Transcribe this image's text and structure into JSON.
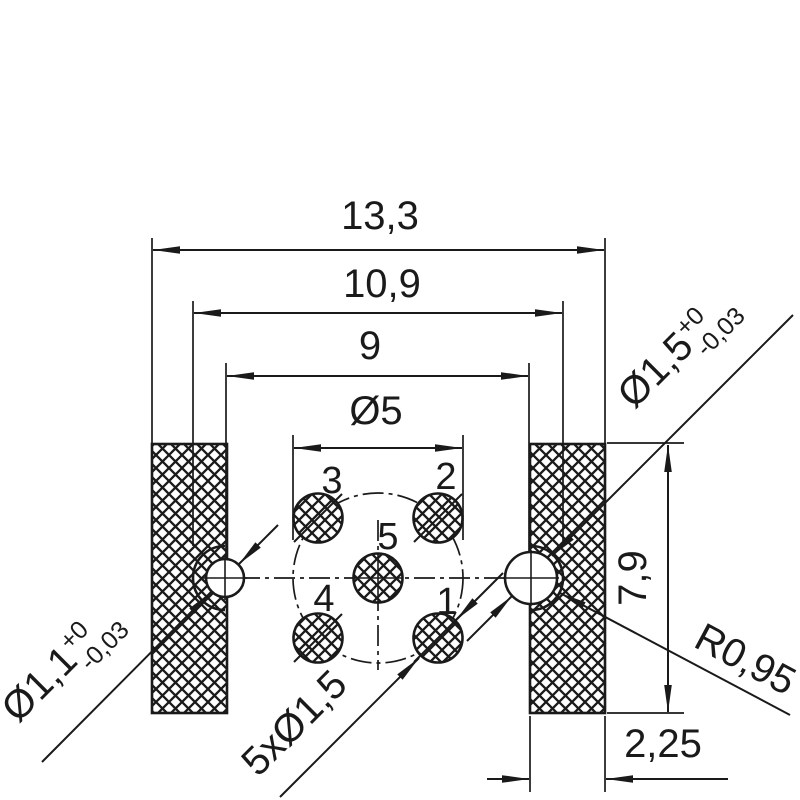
{
  "colors": {
    "ink": "#1a1a1a",
    "background": "#ffffff"
  },
  "dimensions": {
    "overall_width": "13,3",
    "boss_extent_width": "10,9",
    "center_distance": "9",
    "bolt_circle_diameter": "Ø5",
    "block_height": "7,9",
    "block_width": "2,25"
  },
  "labels": {
    "hole_right": {
      "value": "Ø1,5",
      "tol_upper": "+0",
      "tol_lower": "-0,03"
    },
    "hole_left": {
      "value": "Ø1,1",
      "tol_upper": "+0",
      "tol_lower": "-0,03"
    },
    "boss_radius": "R0,95",
    "hole_pattern": "5xØ1,5"
  },
  "hole_numbers": {
    "h1": "1",
    "h2": "2",
    "h3": "3",
    "h4": "4",
    "h5": "5"
  }
}
